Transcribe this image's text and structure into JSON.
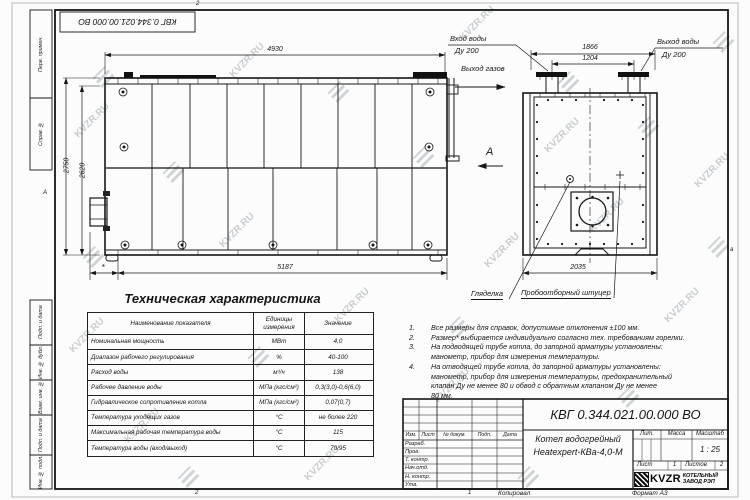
{
  "watermark": {
    "text": "KVZR.RU"
  },
  "sheet": {
    "fold_top": "2",
    "fold_bottom_left": "2",
    "fold_bottom_center": "1",
    "fold_side_left": "А",
    "fold_side_right": "а",
    "copied_label": "Копировал",
    "format_label": "Формат А3"
  },
  "frame_columns": [
    {
      "label": "Перв. примен."
    },
    {
      "label": "Справ. №"
    },
    {
      "label": "Подп. и дата"
    },
    {
      "label": "Инв. № дубл."
    },
    {
      "label": "Взам. инв. №"
    },
    {
      "label": "Подп. и дата"
    },
    {
      "label": "Инв. № подл."
    }
  ],
  "main_view": {
    "dims": {
      "top": "4930",
      "bottom": "5187",
      "bottom_star": "*",
      "left_outer": "2750",
      "left_inner": "2620"
    },
    "labels": {
      "gas_outlet": "Выход газов",
      "view_arrow": "А"
    }
  },
  "side_view": {
    "dims": {
      "flange_outer": "1866",
      "flange_inner": "1204",
      "width": "2035"
    },
    "labels": {
      "water_in_line1": "Вход воды",
      "water_in_line2": "Ду 200",
      "water_out_line1": "Выход воды",
      "water_out_line2": "Ду 200",
      "sight_glass": "Гляделка",
      "sampling": "Пробоотборный штуцер"
    }
  },
  "tech_table": {
    "title": "Техническая характеристика",
    "headers": {
      "name": "Наименование показателя",
      "units": "Единицы измерения",
      "value": "Значение"
    },
    "rows": [
      {
        "name": "Номинальная мощность",
        "units": "МВт",
        "value": "4,0"
      },
      {
        "name": "Диапазон рабочего регулирования",
        "units": "%",
        "value": "40-100"
      },
      {
        "name": "Расход воды",
        "units": "м³/ч",
        "value": "138"
      },
      {
        "name": "Рабочее давление воды",
        "units": "МПа (кгс/см²)",
        "value": "0,3(3,0)-0,6(6,0)"
      },
      {
        "name": "Гидравлическое сопротивление котла",
        "units": "МПа (кгс/см²)",
        "value": "0,07(0,7)"
      },
      {
        "name": "Температура уходящих газов",
        "units": "°С",
        "value": "не более 220"
      },
      {
        "name": "Максимальная рабочая температура воды",
        "units": "°С",
        "value": "115"
      },
      {
        "name": "Температура воды (вход/выход)",
        "units": "°С",
        "value": "70/95"
      }
    ]
  },
  "notes": {
    "items": [
      {
        "num": "1.",
        "text": "Все размеры для справок, допустимые отклонения ±100 мм."
      },
      {
        "num": "2.",
        "text": "Размер* выбирается индивидуально согласно тех. требованиям горелки."
      },
      {
        "num": "3.",
        "text": "На подводящей трубе котла, до запорной арматуры установлены:\nманометр, прибор для измерения температуры."
      },
      {
        "num": "4.",
        "text": "На отводящей трубе котла, до запорной арматуры установлены:\nманометр, прибор для измерения температуры, предохранительный\nклапан Ду не менее 80 и обвод с обратным клапаном Ду не менее\n80 мм."
      }
    ]
  },
  "title_block": {
    "doc_number": "КВГ 0.344.021.00.000 ВО",
    "product_line1": "Котел водогрейный",
    "product_line2": "Heatexpert-КВа-4,0-М",
    "header_cols": {
      "izm": "Изм.",
      "list": "Лист",
      "doc": "№ докум.",
      "podp": "Подп.",
      "data": "Дата"
    },
    "roles": [
      "Разраб.",
      "Пров.",
      "Т. контр.",
      "Нач.отд.",
      "Н. контр.",
      "Утв."
    ],
    "lit_label": "Лит.",
    "mass_label": "Масса",
    "scale_label": "Масштаб",
    "scale_value": "1 : 25",
    "sheet_label": "Лист",
    "sheet_value": "1",
    "sheets_label": "Листов",
    "sheets_value": "2",
    "logo_text": "KVZR",
    "company_line1": "КОТЕЛЬНЫЙ",
    "company_line2": "ЗАВОД РЭП"
  }
}
